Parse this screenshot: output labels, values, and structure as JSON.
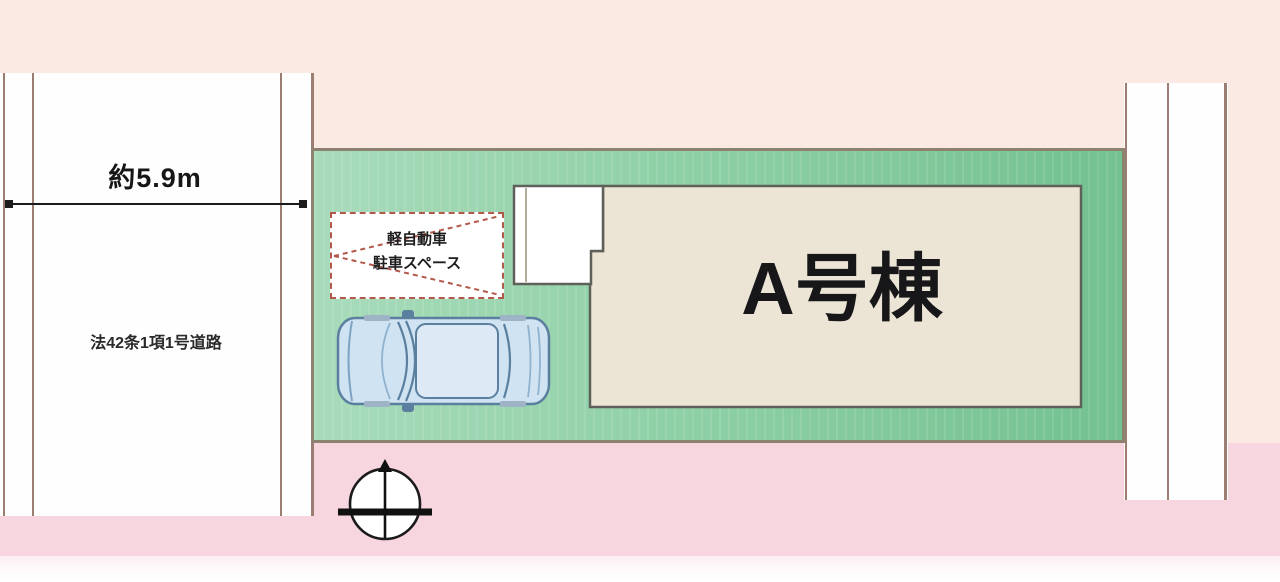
{
  "plan": {
    "left_road": {
      "width_label": "約5.9m",
      "name_label": "法42条1項1号道路"
    },
    "building": {
      "label": "A号棟",
      "fill_color": "#ece4d4",
      "outline_color": "#5e605a"
    },
    "parking_space": {
      "line1": "軽自動車",
      "line2": "駐車スペース",
      "dash_color": "#b3594b"
    },
    "icons": {
      "compass": "north-compass-icon",
      "car": "car-top-view-icon"
    },
    "colors": {
      "background_top": "#fbe9e4",
      "bottom_road_pink": "#f8d6e0",
      "road_white": "#fefefe",
      "road_line": "#9c7d71",
      "plot_green_left": "#a8dbba",
      "plot_green_right": "#74c191",
      "plot_border": "#8d8170",
      "car_body": "#cfe3f2",
      "dimension_line": "#1c1c1c"
    }
  }
}
